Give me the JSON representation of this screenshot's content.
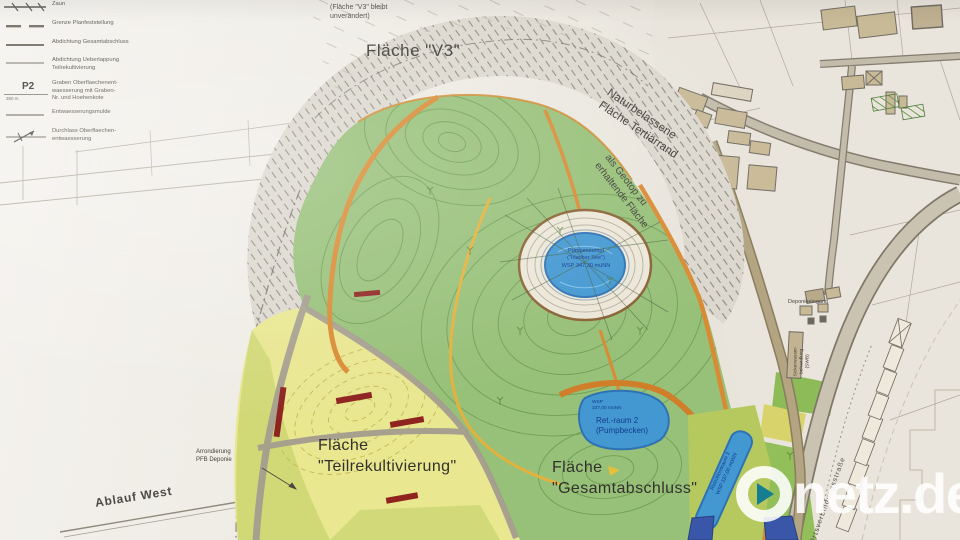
{
  "legend": {
    "items": [
      {
        "id": "zaun",
        "label": "Zaun"
      },
      {
        "id": "grenze",
        "label": "Grenze Planfeststellung"
      },
      {
        "id": "abdichtung-gesamtabschluss",
        "label": "Abdichtung Gesamtabschluss"
      },
      {
        "id": "abdichtung-ueberlappung",
        "label": "Abdichtung Ueberlappung\nTeilrekultivierung"
      },
      {
        "id": "graben",
        "label": "Graben Oberflaechenent-\nwaesserung mit Graben-\nNr. und Hoehenkote",
        "symbol": "P2",
        "sub": "350 m"
      },
      {
        "id": "entwaesserungsmulde",
        "label": "Entwaesserungsmulde"
      },
      {
        "id": "durchlass",
        "label": "Durchlass Oberflaechen-\nentwaesserung"
      }
    ]
  },
  "map_labels": {
    "v3_note": "(Fläche \"V3\" bleibt\nunverändert)",
    "v3_title": "Fläche \"V3\"",
    "natur_tertiaer": "Naturbelassene\nFläche Tertiärrand",
    "geotop": "als Geotop zu\nerhaltende Fläche",
    "pumpensumpf": "Pumpensumpf\n(\"Irlacher See\")\nWSP 347,30 müNN",
    "teilrekultivierung": "Fläche\n\"Teilrekultivierung\"",
    "gesamtabschluss": "Fläche\n\"Gesamtabschluss\"",
    "retraum2_wsp": "WSP\n337,00 müNN",
    "retraum2": "Ret.-raum 2\n(Pumpbecken)",
    "retentionsraum3": "Retentionsraum 3\nWSP 337,00 müNN",
    "arrondierung": "Arrondierung\nPFB Deponie",
    "ablauf_west": "Ablauf West",
    "deponieeingang": "Deponieeingang",
    "sickerwasser": "Sickerwasser-\nbehandlung\n(SWB)",
    "ortsverbindung": "Ortsverbindungsstraße"
  },
  "watermark": {
    "brand": "Onetz.de",
    "brand_rest": "netz.de"
  },
  "colors": {
    "paper": "#efece5",
    "map_green": "#97c078",
    "contour_green": "#69994f",
    "yellow_area": "#e9e790",
    "olive_band": "#ccd672",
    "water_blue": "#4398d2",
    "channel_orange": "#d98b33",
    "building_tan": "#c9ba97",
    "red_marker": "#8e2320",
    "watermark_white": "#ffffff",
    "watermark_teal": "#0e7a94"
  }
}
